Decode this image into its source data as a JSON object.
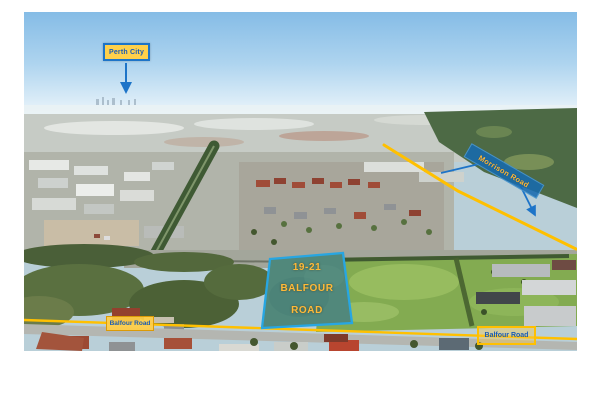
{
  "page": {
    "description": "Aerial drone photograph of an outer Perth suburb used as a property location map, with highlighted roads and an outlined land parcel"
  },
  "photo": {
    "alt": "Aerial view over industrial and residential suburbs looking toward Perth city on the horizon"
  },
  "labels": {
    "perth_city": "Perth City",
    "morrison_road": "Morrison Road",
    "balfour_road_west": "Balfour Road",
    "balfour_road_east": "Balfour Road"
  },
  "property": {
    "address_line1": "19-21",
    "address_line2": "BALFOUR",
    "address_line3": "ROAD"
  },
  "colors": {
    "road_highlight": "#FFC000",
    "annotation_blue": "#1D74C8",
    "label_fill": "#FFD04A",
    "label_text": "#1A5CB4",
    "parcel_outline": "#27A6E2",
    "parcel_fill": "#2876A0",
    "property_text": "#FFB938"
  }
}
